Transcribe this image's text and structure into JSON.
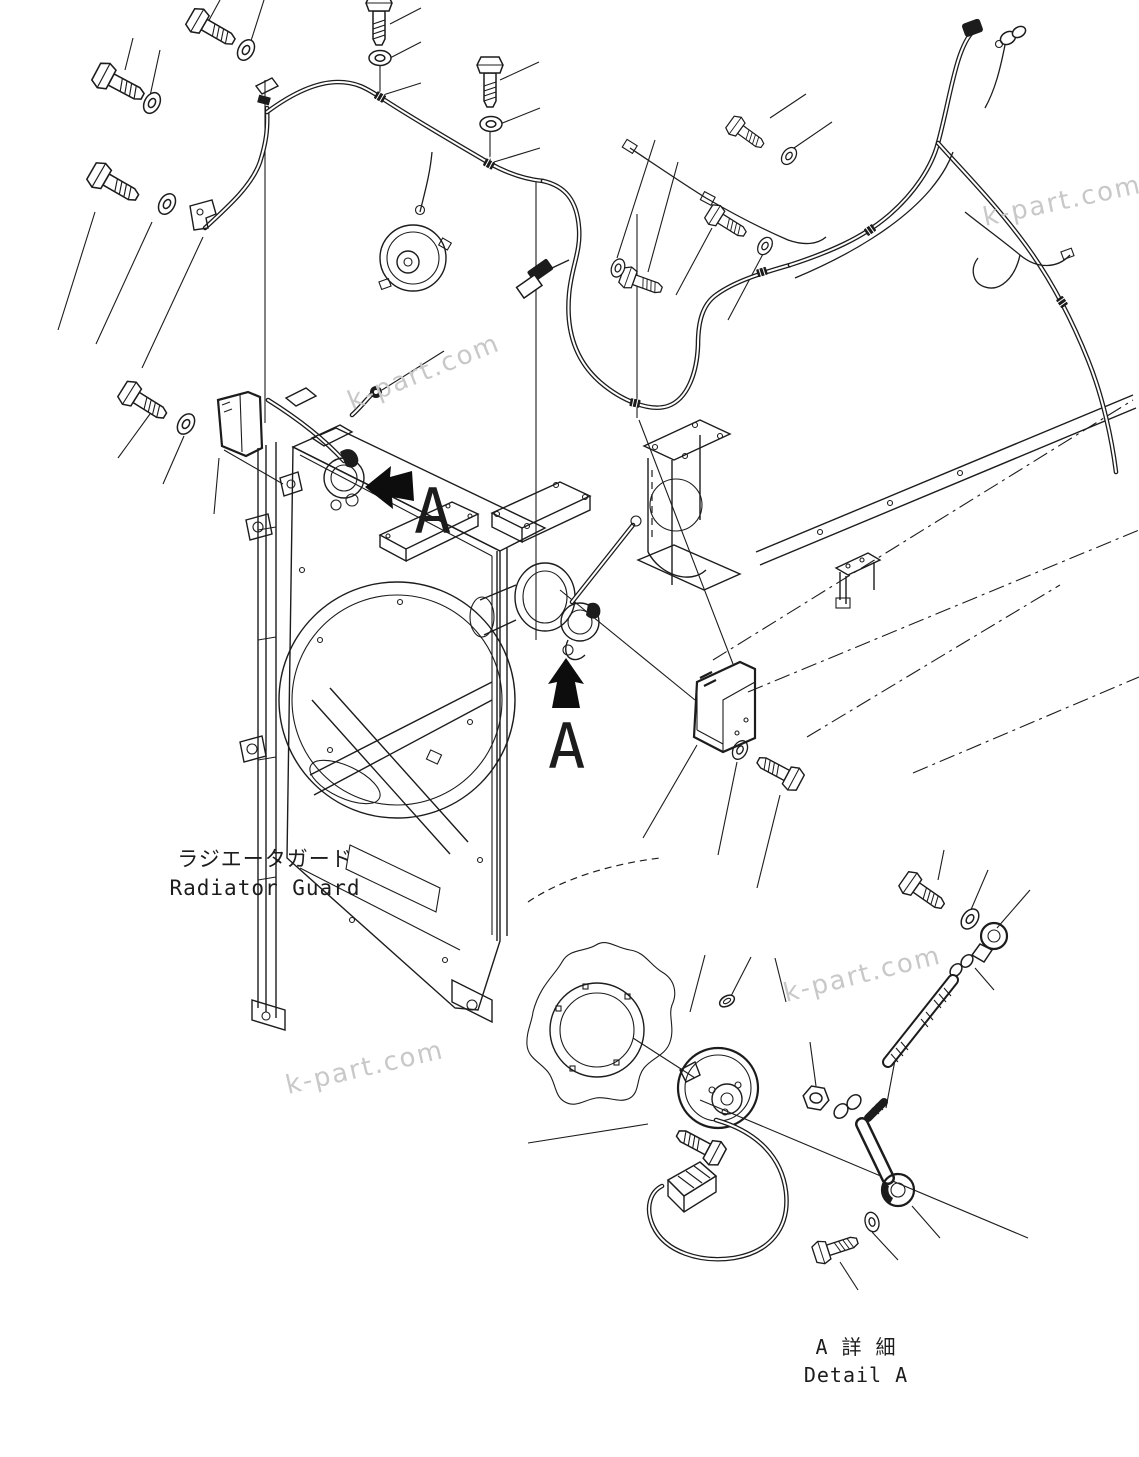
{
  "diagram": {
    "part_label": {
      "jp": "ラジエータガード",
      "en": "Radiator Guard"
    },
    "detail_label": {
      "jp": "A 詳 細",
      "en": "Detail A"
    },
    "view_arrow": {
      "letter": "A"
    },
    "watermark": {
      "text": "k-part.com"
    },
    "colors": {
      "line": "#1c1c1c",
      "watermark": "#c8c8c8",
      "background": "#ffffff",
      "arrow": "#0d0d0d"
    }
  }
}
